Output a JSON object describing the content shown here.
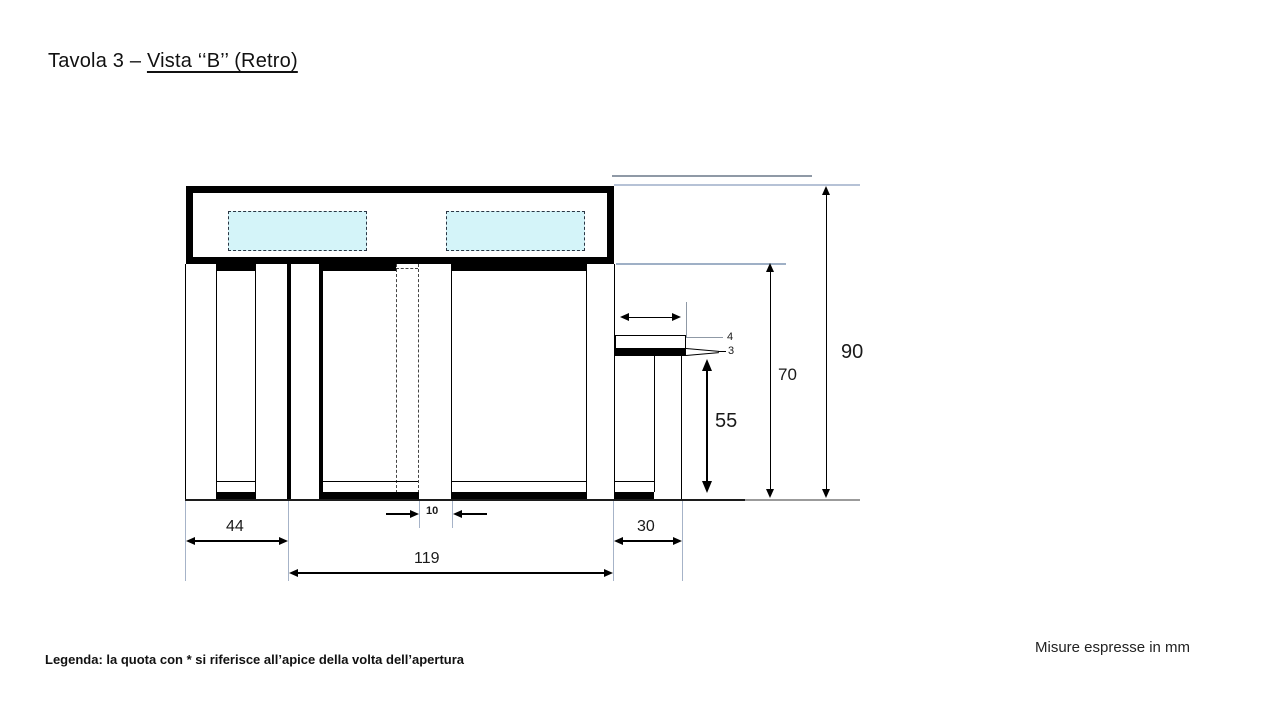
{
  "title": {
    "prefix": "Tavola 3 – ",
    "view": "Vista ‘‘B’’ (Retro)"
  },
  "dimensions": {
    "total_height": "90",
    "front_height": "70",
    "wall_height": "55",
    "slab_thickness": "4",
    "band_thickness": "3",
    "opening_width": "10",
    "left_span": "44",
    "center_span": "119",
    "right_span": "30"
  },
  "legend": "Legenda: la quota con * si riferisce all’apice della volta dell’apertura",
  "units_note": "Misure espresse in mm",
  "colors": {
    "line": "#000000",
    "extension_line": "#a6b3c8",
    "window_fill": "#d4f4f9",
    "ground_gray": "#9b9b9b"
  }
}
